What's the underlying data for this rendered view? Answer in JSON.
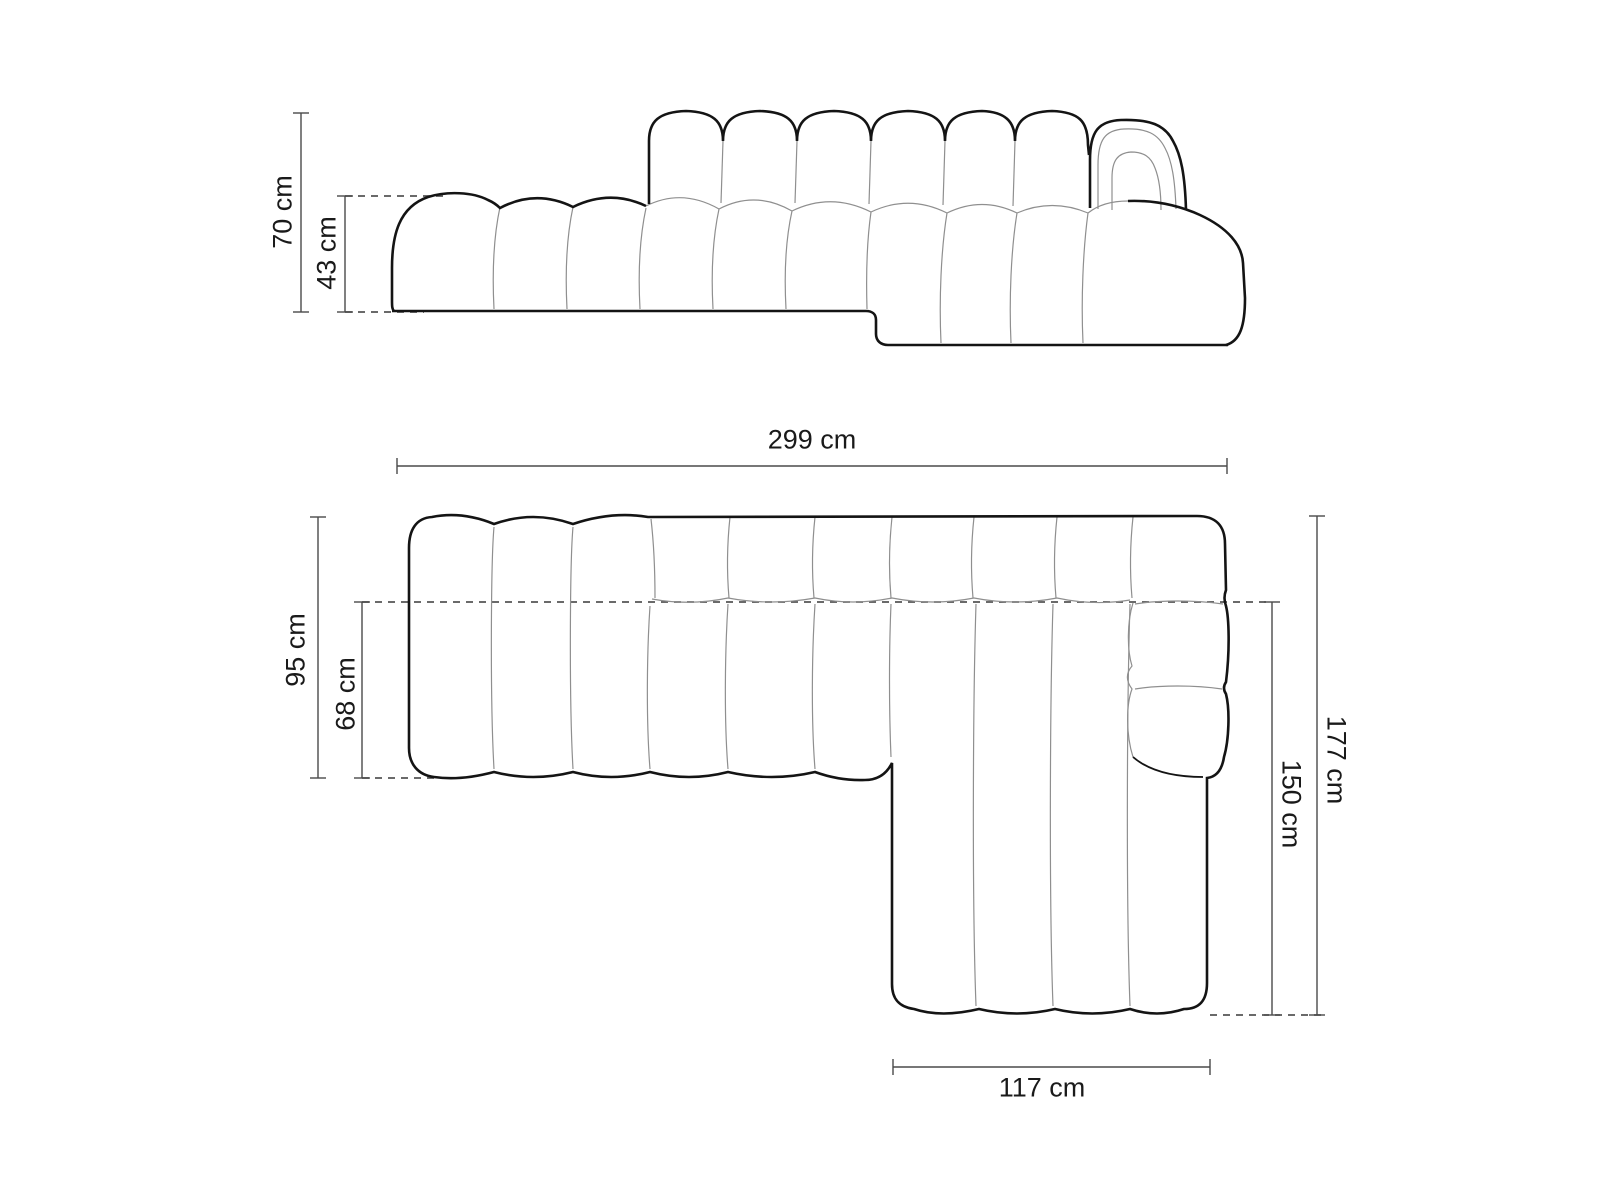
{
  "diagram": {
    "kind": "sofa-technical-drawing",
    "colors": {
      "background": "#ffffff",
      "outline_bold": "#141414",
      "seam_thin": "#8f8f8f",
      "dimension_line": "#4a4a4a",
      "label_text": "#1a1a1a"
    },
    "front_view": {
      "dimensions": {
        "total_height": "70 cm",
        "seat_height": "43 cm"
      }
    },
    "plan_view": {
      "dimensions": {
        "total_width": "299 cm",
        "side_depth": "95 cm",
        "seat_depth": "68 cm",
        "total_depth": "177 cm",
        "chaise_length": "150 cm",
        "chaise_width": "117 cm"
      }
    }
  }
}
